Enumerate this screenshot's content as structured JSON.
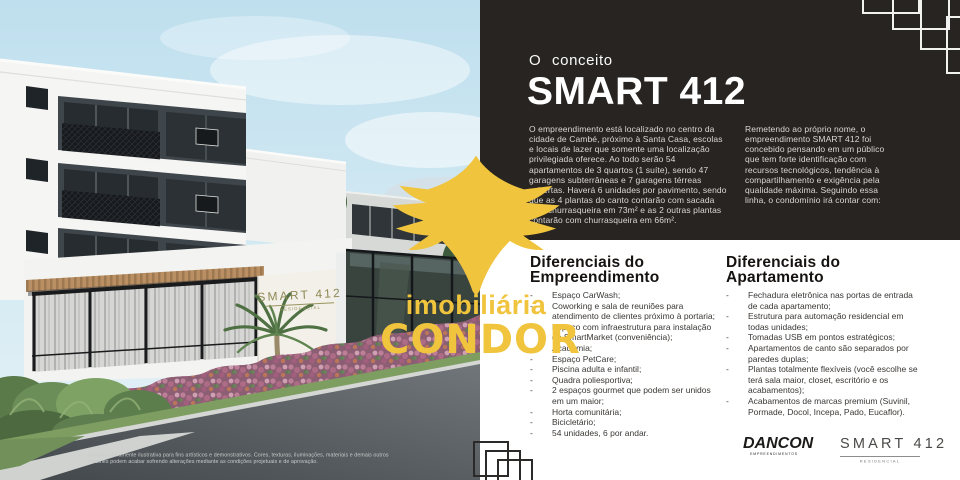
{
  "colors": {
    "accent_yellow": "#f0c43c",
    "panel_dark": "#272421",
    "signage_gold": "#8e8955",
    "heading_dark": "#151210"
  },
  "photo": {
    "signage": {
      "title": "SMART 412",
      "subtitle": "RESIDENCIAL"
    },
    "disclaimer": "Imagem meramente ilustrativa para fins artísticos e demonstrativos. Cores, texturas, iluminações, materiais e demais outros detalhes podem acabar sofrendo alterações mediante as condições projetuais e de aprovação."
  },
  "watermark": {
    "brand_top": "imobiliária",
    "brand_bottom": "CONDOR"
  },
  "concept": {
    "kicker": "O conceito",
    "title": "SMART 412",
    "paragraph_left": "O empreendimento está localizado no centro da cidade de Cambé, próximo à Santa Casa, escolas e locais de lazer que somente uma localização privilegiada oferece. Ao todo serão 54 apartamentos de 3 quartos (1 suíte), sendo 47 garagens subterrâneas e 7 garagens térreas cobertas. Haverá 6 unidades por pavimento, sendo que as 4 plantas do canto contarão com sacada com churrasqueira em 73m² e as 2 outras plantas contarão com churrasqueira em 66m².",
    "paragraph_right": "Remetendo ao próprio nome, o empreendimento SMART 412 foi concebido pensando em um público que tem forte identificação com recursos tecnológicos, tendência à compartilhamento e exigência pela qualidade máxima. Seguindo essa linha, o condomínio irá contar com:"
  },
  "differentials": {
    "development": {
      "title": "Diferenciais do Empreendimento",
      "items": [
        "Espaço CarWash;",
        "Coworking e sala de reuniões para atendimento de clientes próximo à portaria;",
        "Espaço com infraestrutura para instalação de SmartMarket (conveniência);",
        "Academia;",
        "Espaço PetCare;",
        "Piscina adulta e infantil;",
        "Quadra poliesportiva;",
        "2 espaços gourmet que podem ser unidos em um maior;",
        "Horta comunitária;",
        "Bicicletário;",
        "54 unidades, 6 por andar."
      ]
    },
    "apartment": {
      "title": "Diferenciais do Apartamento",
      "items": [
        "Fechadura eletrônica nas portas de entrada de cada apartamento;",
        "Estrutura para automação residencial em todas unidades;",
        "Tomadas USB em pontos estratégicos;",
        "Apartamentos de canto são separados por paredes duplas;",
        "Plantas totalmente flexíveis (você escolhe se terá sala maior, closet, escritório e os acabamentos);",
        "Acabamentos de marcas premium (Suvinil, Pormade, Docol, Incepa, Pado, Eucaflor)."
      ]
    }
  },
  "footer_logos": {
    "dancon": {
      "name": "DANCON",
      "subtitle": "EMPREENDIMENTOS"
    },
    "smart": {
      "name": "SMART 412",
      "subtitle": "RESIDENCIAL"
    }
  }
}
